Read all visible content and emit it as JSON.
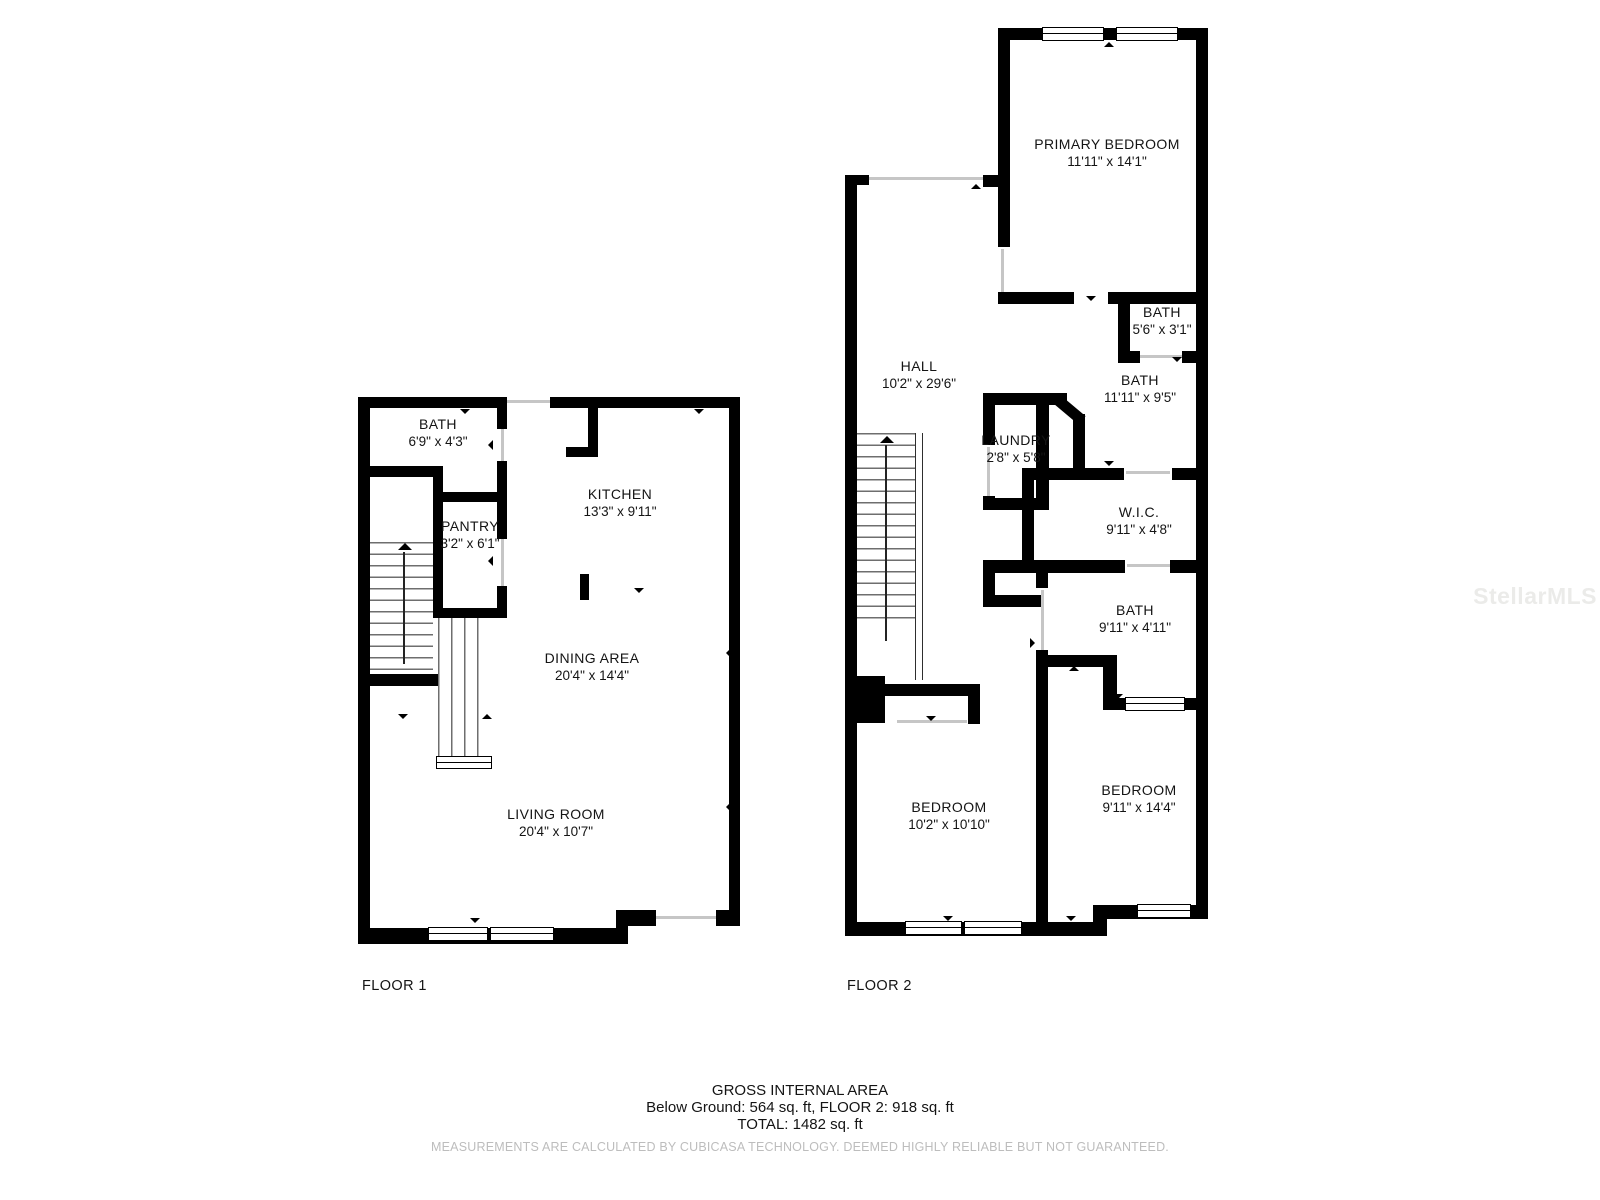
{
  "meta": {
    "background": "#ffffff",
    "wall_color": "#000000",
    "text_color": "#141414",
    "muted_color": "#bdbdbd"
  },
  "watermark": "StellarMLS",
  "floors": [
    {
      "label": "FLOOR 1",
      "rooms": [
        {
          "name": "BATH",
          "dims": "6'9\" x 4'3\""
        },
        {
          "name": "PANTRY",
          "dims": "3'2\" x 6'1\""
        },
        {
          "name": "KITCHEN",
          "dims": "13'3\" x 9'11\""
        },
        {
          "name": "DINING AREA",
          "dims": "20'4\" x 14'4\""
        },
        {
          "name": "LIVING ROOM",
          "dims": "20'4\" x 10'7\""
        }
      ]
    },
    {
      "label": "FLOOR 2",
      "rooms": [
        {
          "name": "PRIMARY BEDROOM",
          "dims": "11'11\" x 14'1\""
        },
        {
          "name": "HALL",
          "dims": "10'2\" x 29'6\""
        },
        {
          "name": "BATH",
          "dims": "5'6\" x 3'1\""
        },
        {
          "name": "BATH",
          "dims": "11'11\" x 9'5\""
        },
        {
          "name": "LAUNDRY",
          "dims": "2'8\" x 5'8\""
        },
        {
          "name": "W.I.C.",
          "dims": "9'11\" x 4'8\""
        },
        {
          "name": "BATH",
          "dims": "9'11\" x 4'11\""
        },
        {
          "name": "BEDROOM",
          "dims": "10'2\" x 10'10\""
        },
        {
          "name": "BEDROOM",
          "dims": "9'11\" x 14'4\""
        }
      ]
    }
  ],
  "footer": {
    "title": "GROSS INTERNAL AREA",
    "line1": "Below Ground: 564 sq. ft, FLOOR 2: 918 sq. ft",
    "line2": "TOTAL: 1482 sq. ft",
    "disclaimer": "MEASUREMENTS ARE CALCULATED BY CUBICASA TECHNOLOGY. DEEMED HIGHLY RELIABLE BUT NOT GUARANTEED."
  }
}
